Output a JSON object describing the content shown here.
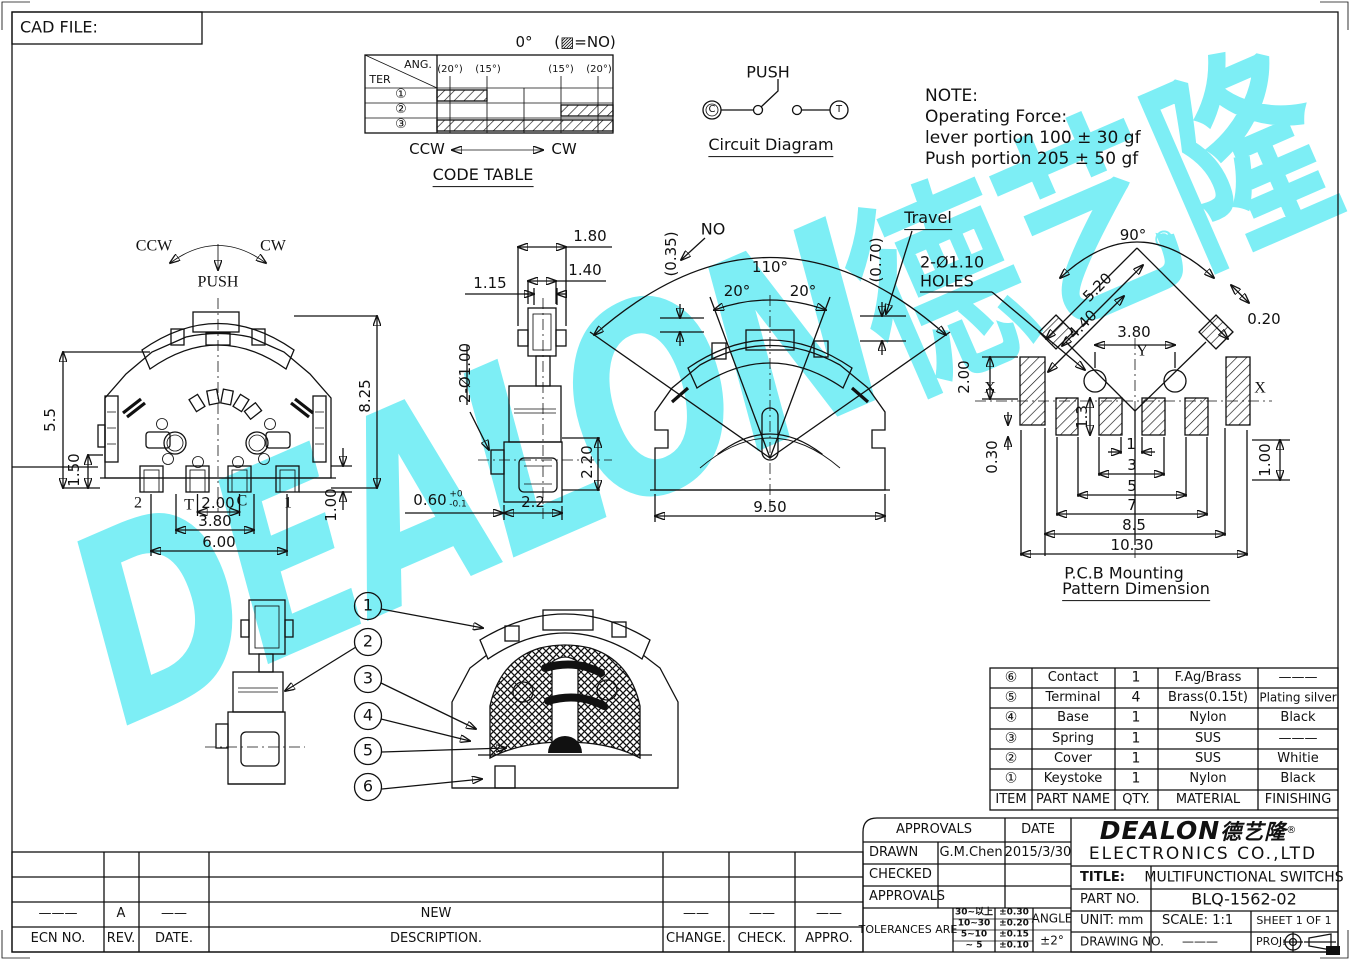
{
  "sheet": {
    "cad_file_label": "CAD FILE:"
  },
  "watermark": {
    "latin": "DEALON",
    "cjk": "德艺隆",
    "registered": "®",
    "color": "#7deef5"
  },
  "code_table": {
    "zero": "0°",
    "legend": "(▨=NO)",
    "ter": "TER",
    "ang": "ANG.",
    "cols": [
      "(20°)",
      "(15°)",
      "(15°)",
      "(20°)"
    ],
    "rows": [
      "①",
      "②",
      "③"
    ],
    "ccw": "CCW",
    "cw": "CW",
    "caption": "CODE TABLE"
  },
  "circuit": {
    "push": "PUSH",
    "c": "C",
    "t": "T",
    "caption": "Circuit Diagram"
  },
  "note": {
    "l1": "NOTE:",
    "l2": "Operating Force:",
    "l3": "lever portion 100 ± 30 gf",
    "l4": "Push portion 205 ± 50 gf"
  },
  "front_view": {
    "ccw": "CCW",
    "cw": "CW",
    "push": "PUSH",
    "dim_55": "5.5",
    "dim_150": "1.50",
    "dim_825": "8.25",
    "dim_100": "1.00",
    "dim_200": "2.00",
    "dim_380": "3.80",
    "dim_600": "6.00",
    "t2": "2",
    "tt": "T",
    "tc": "C",
    "t1": "1"
  },
  "side_view": {
    "dim_180": "1.80",
    "dim_140": "1.40",
    "dim_115": "1.15",
    "dim_2d100": "2-Ø1.00",
    "dim_220": "2.20",
    "dim_060": "0.60",
    "tol_up": "+0",
    "tol_dn": "-0.1",
    "dim_22": "2.2"
  },
  "center_view": {
    "no": "NO",
    "no_val": "(0.35)",
    "travel": "Travel",
    "travel_val": "(0.70)",
    "a110": "110°",
    "a20l": "20°",
    "a20r": "20°",
    "dim_950": "9.50"
  },
  "pcb": {
    "holes_line1": "2-Ø1.10",
    "holes_line2": "HOLES",
    "a90": "90°",
    "registered": "®",
    "d520": "5.20",
    "d440": "4.40",
    "d380": "3.80",
    "d020": "0.20",
    "d200": "2.00",
    "d030": "0.30",
    "d13": "1.3",
    "d1": "1",
    "d3": "3",
    "d5": "5",
    "d7": "7",
    "d85": "8.5",
    "d1030": "10.30",
    "d100": "1.00",
    "x_left": "X",
    "x_right": "X",
    "y": "Y",
    "caption1": "P.C.B Mounting",
    "caption2": "Pattern Dimension"
  },
  "balloons": [
    "1",
    "2",
    "3",
    "4",
    "5",
    "6"
  ],
  "parts_table": {
    "headers": {
      "item": "ITEM",
      "name": "PART NAME",
      "qty": "QTY.",
      "material": "MATERIAL",
      "finishing": "FINISHING"
    },
    "rows": [
      {
        "item": "⑥",
        "name": "Contact",
        "qty": "1",
        "material": "F.Ag/Brass",
        "finishing": "———"
      },
      {
        "item": "⑤",
        "name": "Terminal",
        "qty": "4",
        "material": "Brass(0.15t)",
        "finishing": "Plating silver"
      },
      {
        "item": "④",
        "name": "Base",
        "qty": "1",
        "material": "Nylon",
        "finishing": "Black"
      },
      {
        "item": "③",
        "name": "Spring",
        "qty": "1",
        "material": "SUS",
        "finishing": "———"
      },
      {
        "item": "②",
        "name": "Cover",
        "qty": "1",
        "material": "SUS",
        "finishing": "Whitie"
      },
      {
        "item": "①",
        "name": "Keystoke",
        "qty": "1",
        "material": "Nylon",
        "finishing": "Black"
      }
    ]
  },
  "title_block": {
    "approvals": "APPROVALS",
    "date": "DATE",
    "drawn": "DRAWN",
    "drawn_by": "G.M.Chen",
    "drawn_date": "2015/3/30",
    "checked": "CHECKED",
    "approvals2": "APPROVALS",
    "tolerances": "TOLERANCES ARE",
    "tol": [
      {
        "range": "30~以上",
        "val": "±0.30"
      },
      {
        "range": "10~30",
        "val": "±0.20"
      },
      {
        "range": "5~10",
        "val": "±0.15"
      },
      {
        "range": "~ 5",
        "val": "±0.10"
      }
    ],
    "angle": "ANGLE",
    "angle_val": "±2°",
    "logo": "DEALON",
    "logo_cjk": "德艺隆",
    "registered": "®",
    "company": "ELECTRONICS CO.,LTD",
    "title_label": "TITLE:",
    "title_value": "MULTIFUNCTIONAL SWITCHS",
    "part_label": "PART NO.",
    "part_value": "BLQ-1562-02",
    "unit": "UNIT: mm",
    "scale": "SCALE: 1:1",
    "sheet": "SHEET 1 OF 1",
    "drawing_label": "DRAWING NO.",
    "drawing_value": "———",
    "proj": "PROJ:"
  },
  "revision": {
    "row": {
      "ecn": "———",
      "rev": "A",
      "date": "——",
      "desc": "NEW",
      "change": "——",
      "check": "——",
      "appro": "——"
    },
    "headers": {
      "ecn": "ECN NO.",
      "rev": "REV.",
      "date": "DATE.",
      "desc": "DESCRIPTION.",
      "change": "CHANGE.",
      "check": "CHECK.",
      "appro": "APPRO."
    }
  }
}
